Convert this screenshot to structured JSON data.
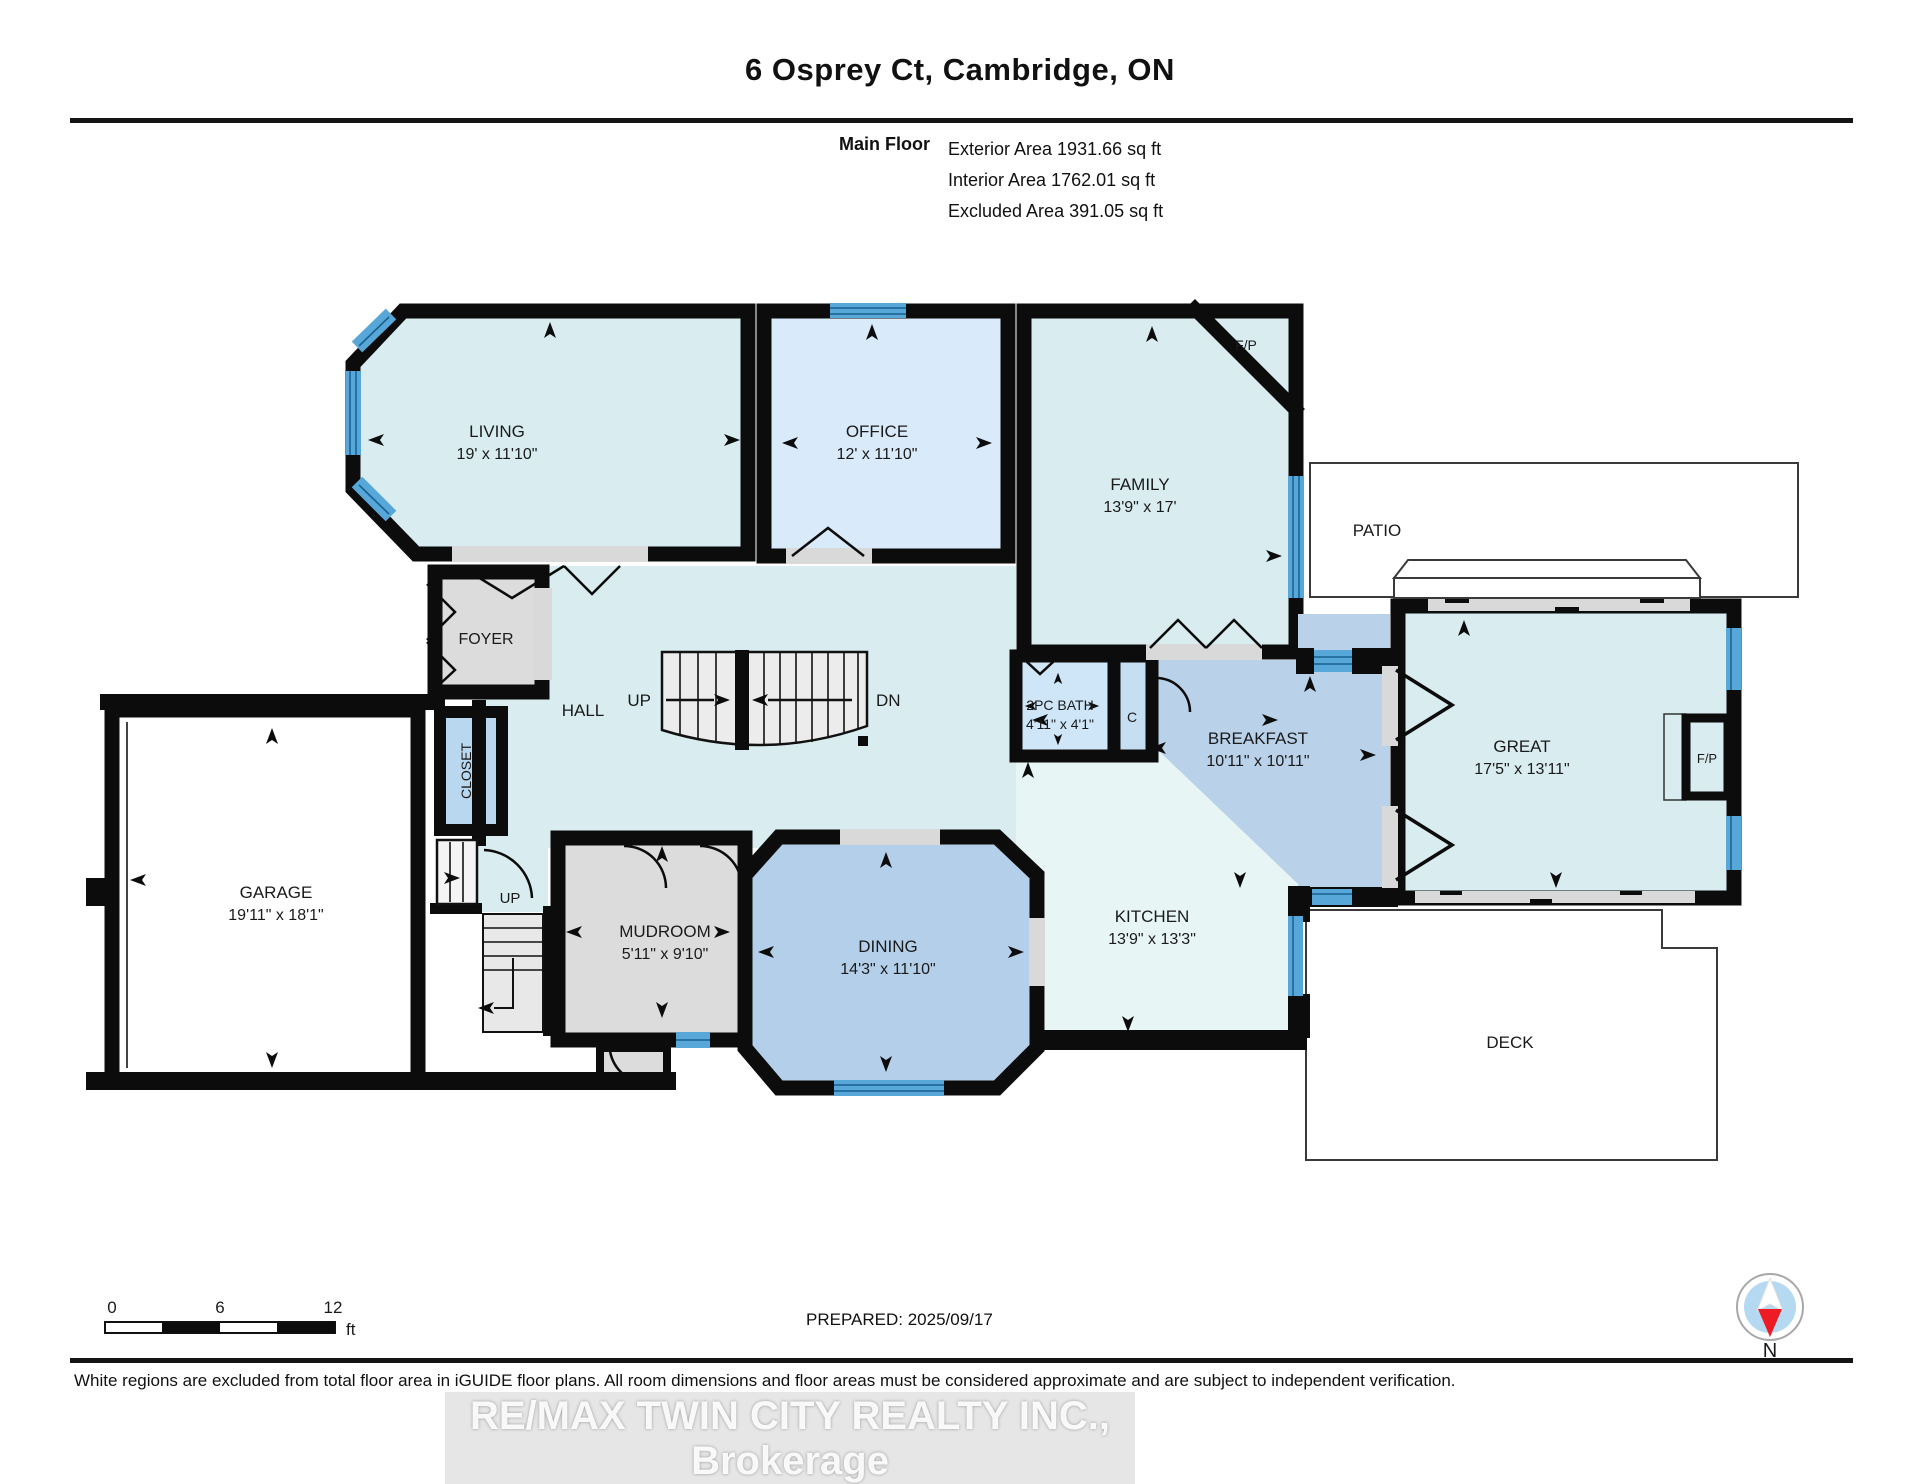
{
  "title": "6 Osprey Ct, Cambridge, ON",
  "header": {
    "floor_label": "Main Floor",
    "exterior": "Exterior Area 1931.66 sq ft",
    "interior": "Interior Area 1762.01 sq ft",
    "excluded": "Excluded Area 391.05 sq ft"
  },
  "rooms": {
    "living": {
      "name": "LIVING",
      "dims": "19' x 11'10\""
    },
    "office": {
      "name": "OFFICE",
      "dims": "12' x 11'10\""
    },
    "family": {
      "name": "FAMILY",
      "dims": "13'9\" x 17'"
    },
    "great": {
      "name": "GREAT",
      "dims": "17'5\" x 13'11\""
    },
    "breakfast": {
      "name": "BREAKFAST",
      "dims": "10'11\" x 10'11\""
    },
    "kitchen": {
      "name": "KITCHEN",
      "dims": "13'9\" x 13'3\""
    },
    "dining": {
      "name": "DINING",
      "dims": "14'3\" x 11'10\""
    },
    "mudroom": {
      "name": "MUDROOM",
      "dims": "5'11\" x 9'10\""
    },
    "garage": {
      "name": "GARAGE",
      "dims": "19'11\" x 18'1\""
    },
    "bath": {
      "name": "2PC BATH",
      "dims": "4'11\" x 4'1\""
    },
    "foyer": {
      "name": "FOYER"
    },
    "hall": {
      "name": "HALL"
    },
    "closet": {
      "name": "CLOSET"
    },
    "closet_c": {
      "name": "C"
    },
    "patio": {
      "name": "PATIO"
    },
    "deck": {
      "name": "DECK"
    }
  },
  "labels": {
    "fp_family": "F/P",
    "fp_great": "F/P",
    "up_main": "UP",
    "dn_main": "DN",
    "up_side": "UP"
  },
  "scale_bar": {
    "t0": "0",
    "t6": "6",
    "t12": "12",
    "unit": "ft"
  },
  "compass": {
    "north": "N"
  },
  "footer": {
    "prepared": "PREPARED: 2025/09/17",
    "disclaimer": "White regions are excluded from total floor area in iGUIDE floor plans. All room dimensions and floor areas must be considered approximate and are subject to independent verification.",
    "watermark": "RE/MAX TWIN CITY REALTY INC., Brokerage"
  },
  "colors": {
    "wall": "#0c0c0c",
    "window_blue": "#57a8d9",
    "window_stripe": "#19608f",
    "room_cyan": "#d9edf0",
    "office_blue": "#d9eafa",
    "bath_blue": "#cfe6f8",
    "closet_blue": "#b9d8f0",
    "kitchen_pale": "#e7f5f5",
    "dining_steel": "#b4cfe9",
    "breakfast_steel": "#b9d1e9",
    "gray_room": "#dcdcdc",
    "opening_gray": "#d9d9d9",
    "compass_red": "#ed1c24",
    "compass_blue": "#b5d9f1"
  }
}
